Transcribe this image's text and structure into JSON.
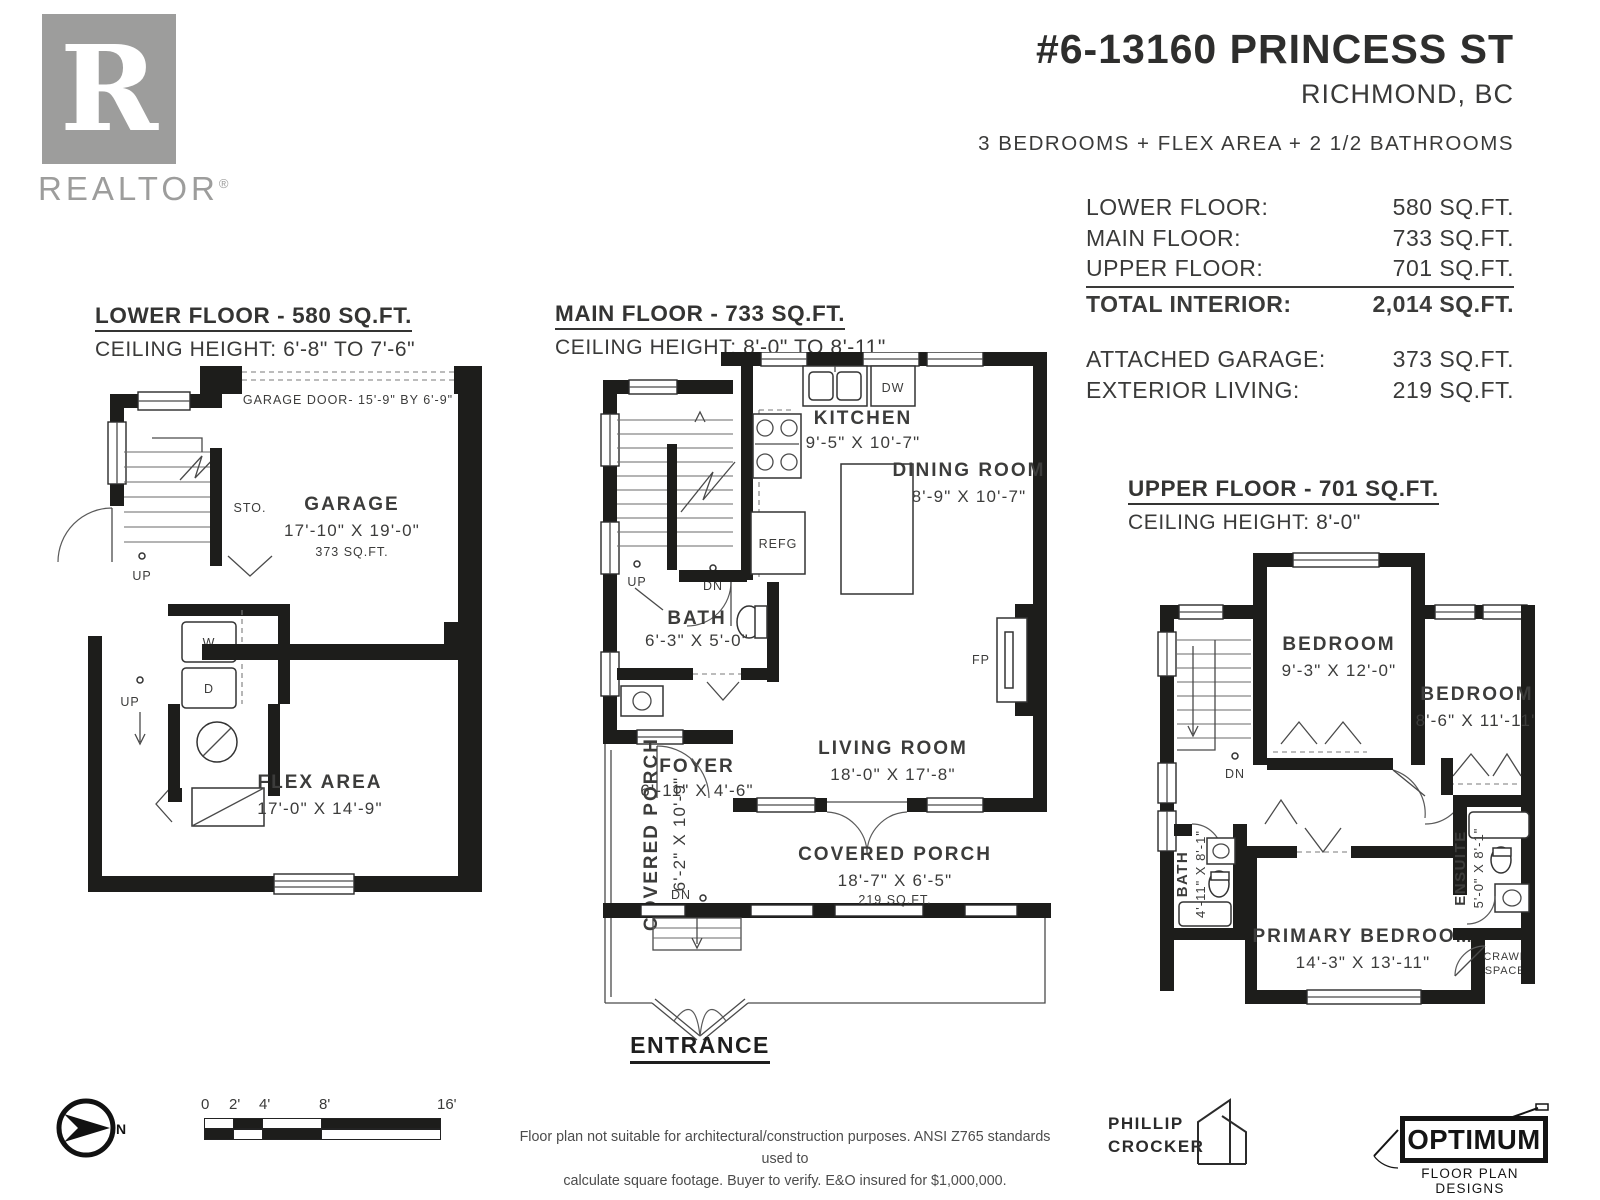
{
  "colors": {
    "wall": "#1d1d1b",
    "text": "#3c3c3b",
    "realtor_gray": "#9d9d9c"
  },
  "realtor": {
    "letter": "R",
    "text": "REALTOR",
    "reg": "®"
  },
  "header": {
    "address": "#6-13160 PRINCESS ST",
    "city": "RICHMOND, BC",
    "summary": "3 BEDROOMS + FLEX AREA + 2 1/2 BATHROOMS"
  },
  "stats": {
    "rows": [
      {
        "label": "LOWER FLOOR:",
        "value": "580 SQ.FT."
      },
      {
        "label": "MAIN FLOOR:",
        "value": "733 SQ.FT."
      },
      {
        "label": "UPPER FLOOR:",
        "value": "701 SQ.FT."
      },
      {
        "label": "TOTAL INTERIOR:",
        "value": "2,014 SQ.FT."
      }
    ],
    "extra": [
      {
        "label": "ATTACHED GARAGE:",
        "value": "373 SQ.FT."
      },
      {
        "label": "EXTERIOR LIVING:",
        "value": "219 SQ.FT."
      }
    ]
  },
  "floors": {
    "lower": {
      "title": "LOWER FLOOR - 580 SQ.FT.",
      "ceiling": "CEILING HEIGHT: 6'-8\" TO 7'-6\"",
      "labels": {
        "garage_door": "GARAGE DOOR- 15'-9\" BY 6'-9\"",
        "sto": "STO.",
        "up1": "UP",
        "up2": "UP",
        "garage_name": "GARAGE",
        "garage_dim": "17'-10\" X 19'-0\"",
        "garage_area": "373 SQ.FT.",
        "w": "W",
        "d": "D",
        "flex_name": "FLEX AREA",
        "flex_dim": "17'-0\" X 14'-9\""
      }
    },
    "main": {
      "title": "MAIN FLOOR - 733 SQ.FT.",
      "ceiling": "CEILING HEIGHT: 8'-0\" TO 8'-11\"",
      "labels": {
        "kitchen_name": "KITCHEN",
        "kitchen_dim": "9'-5\" X 10'-7\"",
        "dw": "DW",
        "refg": "REFG",
        "dining_name": "DINING ROOM",
        "dining_dim": "8'-9\" X 10'-7\"",
        "up": "UP",
        "dn": "DN",
        "dn2": "DN",
        "bath_name": "BATH",
        "bath_dim": "6'-3\" X 5'-0\"",
        "foyer_name": "FOYER",
        "foyer_dim": "6'-11\" X 4'-6\"",
        "living_name": "LIVING ROOM",
        "living_dim": "18'-0\" X 17'-8\"",
        "fp": "FP",
        "porch_side_name": "COVERED PORCH",
        "porch_side_dim": "6'-2\" X 10'-9\"",
        "porch_front_name": "COVERED PORCH",
        "porch_front_dim": "18'-7\" X 6'-5\"",
        "porch_front_area": "219 SQ.FT.",
        "entrance": "ENTRANCE"
      }
    },
    "upper": {
      "title": "UPPER FLOOR - 701 SQ.FT.",
      "ceiling": "CEILING HEIGHT: 8'-0\"",
      "labels": {
        "bedroom1_name": "BEDROOM",
        "bedroom1_dim": "9'-3\" X 12'-0\"",
        "bedroom2_name": "BEDROOM",
        "bedroom2_dim": "8'-6\" X 11'-11\"",
        "dn": "DN",
        "bath_name": "BATH",
        "bath_dim": "4'-11\" X 8'-1\"",
        "primary_name": "PRIMARY BEDROOM",
        "primary_dim": "14'-3\" X 13'-11\"",
        "ensuite_name": "ENSUITE",
        "ensuite_dim": "5'-0\" X 8'-1\"",
        "crawl1": "CRAWL",
        "crawl2": "SPACE"
      }
    }
  },
  "footer": {
    "north": "N",
    "scale_ticks": [
      "0",
      "2'",
      "4'",
      "8'",
      "16'"
    ],
    "disclaimer1": "Floor plan not suitable for architectural/construction purposes. ANSI Z765 standards used to",
    "disclaimer2": "calculate square footage. Buyer to verify.  E&O insured for $1,000,000.",
    "phillip1": "PHILLIP",
    "phillip2": "CROCKER",
    "optimum": "OPTIMUM",
    "optimum_sub": "FLOOR PLAN DESIGNS"
  }
}
